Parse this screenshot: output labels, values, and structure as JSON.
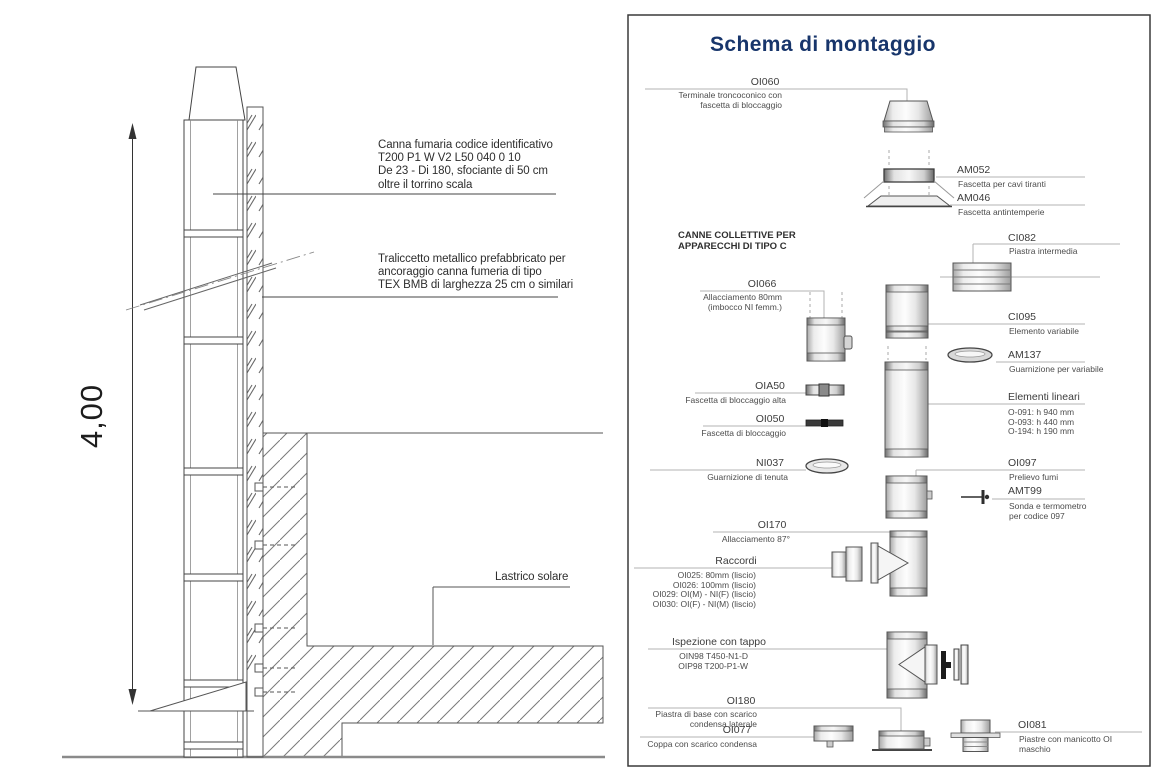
{
  "colors": {
    "accent_navy": "#17356b",
    "line_gray": "#555555",
    "leader_gray": "#b3b3b3"
  },
  "left_drawing": {
    "dimension_label": "4,00",
    "canna_fumaria_note": [
      "Canna fumaria codice identificativo",
      "T200 P1 W V2 L50 040 0 10",
      "De 23 - Di 180, sfociante di 50 cm",
      "oltre il torrino scala"
    ],
    "traliccetto_note": [
      "Traliccetto metallico prefabbricato per",
      "ancoraggio canna fumeria di tipo",
      "TEX BMB di larghezza 25 cm o similari"
    ],
    "lastrico_label": "Lastrico solare"
  },
  "panel": {
    "title": "Schema di montaggio",
    "section_heading": [
      "CANNE COLLETTIVE PER",
      "APPARECCHI DI TIPO C"
    ],
    "parts": [
      {
        "code": "OI060",
        "desc": [
          "Terminale troncoconico con",
          "fascetta di bloccaggio"
        ]
      },
      {
        "code": "AM052",
        "desc": [
          "Fascetta per cavi tiranti"
        ]
      },
      {
        "code": "AM046",
        "desc": [
          "Fascetta antintemperie"
        ]
      },
      {
        "code": "CI082",
        "desc": [
          "Piastra intermedia"
        ]
      },
      {
        "code": "OI066",
        "desc": [
          "Allacciamento 80mm",
          "(imbocco NI femm.)"
        ]
      },
      {
        "code": "CI095",
        "desc": [
          "Elemento variabile"
        ]
      },
      {
        "code": "AM137",
        "desc": [
          "Guarnizione per variabile"
        ]
      },
      {
        "code": "OIA50",
        "desc": [
          "Fascetta di bloccaggio alta"
        ]
      },
      {
        "code": "OI050",
        "desc": [
          "Fascetta di bloccaggio"
        ]
      },
      {
        "code": "Elementi lineari",
        "desc": [
          "O-091: h 940 mm",
          "O-093: h 440 mm",
          "O-194: h 190 mm"
        ]
      },
      {
        "code": "NI037",
        "desc": [
          "Guarnizione di tenuta"
        ]
      },
      {
        "code": "OI097",
        "desc": [
          "Prelievo fumi"
        ]
      },
      {
        "code": "AMT99",
        "desc": [
          "Sonda e termometro",
          "per codice 097"
        ]
      },
      {
        "code": "OI170",
        "desc": [
          "Allacciamento 87°"
        ]
      },
      {
        "code": "Raccordi",
        "desc": [
          "OI025: 80mm (liscio)",
          "OI026: 100mm (liscio)",
          "OI029: OI(M) - NI(F) (liscio)",
          "OI030: OI(F) - NI(M) (liscio)"
        ]
      },
      {
        "code": "Ispezione con tappo",
        "desc": [
          "OIN98 T450-N1-D",
          "OIP98 T200-P1-W"
        ]
      },
      {
        "code": "OI180",
        "desc": [
          "Piastra di base con scarico",
          "condensa laterale"
        ]
      },
      {
        "code": "OI077",
        "desc": [
          "Coppa con scarico condensa"
        ]
      },
      {
        "code": "OI081",
        "desc": [
          "Piastre con manicotto OI",
          "maschio"
        ]
      }
    ]
  }
}
